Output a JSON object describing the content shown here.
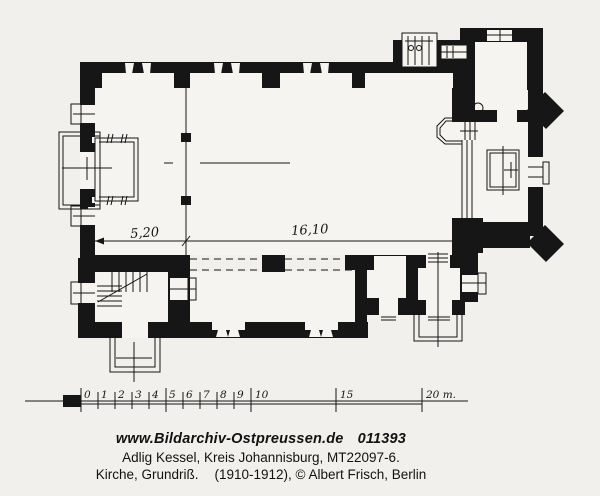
{
  "plan": {
    "dimension_labels": {
      "porch_width": "5,20",
      "nave_length": "16,10"
    }
  },
  "scale_bar": {
    "tick_labels": [
      "0",
      "1",
      "2",
      "3",
      "4",
      "5",
      "6",
      "7",
      "8",
      "9",
      "10",
      "15",
      "20 m."
    ]
  },
  "caption": {
    "website": "www.Bildarchiv-Ostpreussen.de",
    "archive_number": "011393",
    "location_line": "Adlig Kessel, Kreis Johannisburg, MT22097-6.",
    "subject": "Kirche, Grundriß.",
    "credit": "(1910-1912), © Albert Frisch, Berlin"
  },
  "colors": {
    "ink": "#161616",
    "paper": "#f2f0ec"
  }
}
